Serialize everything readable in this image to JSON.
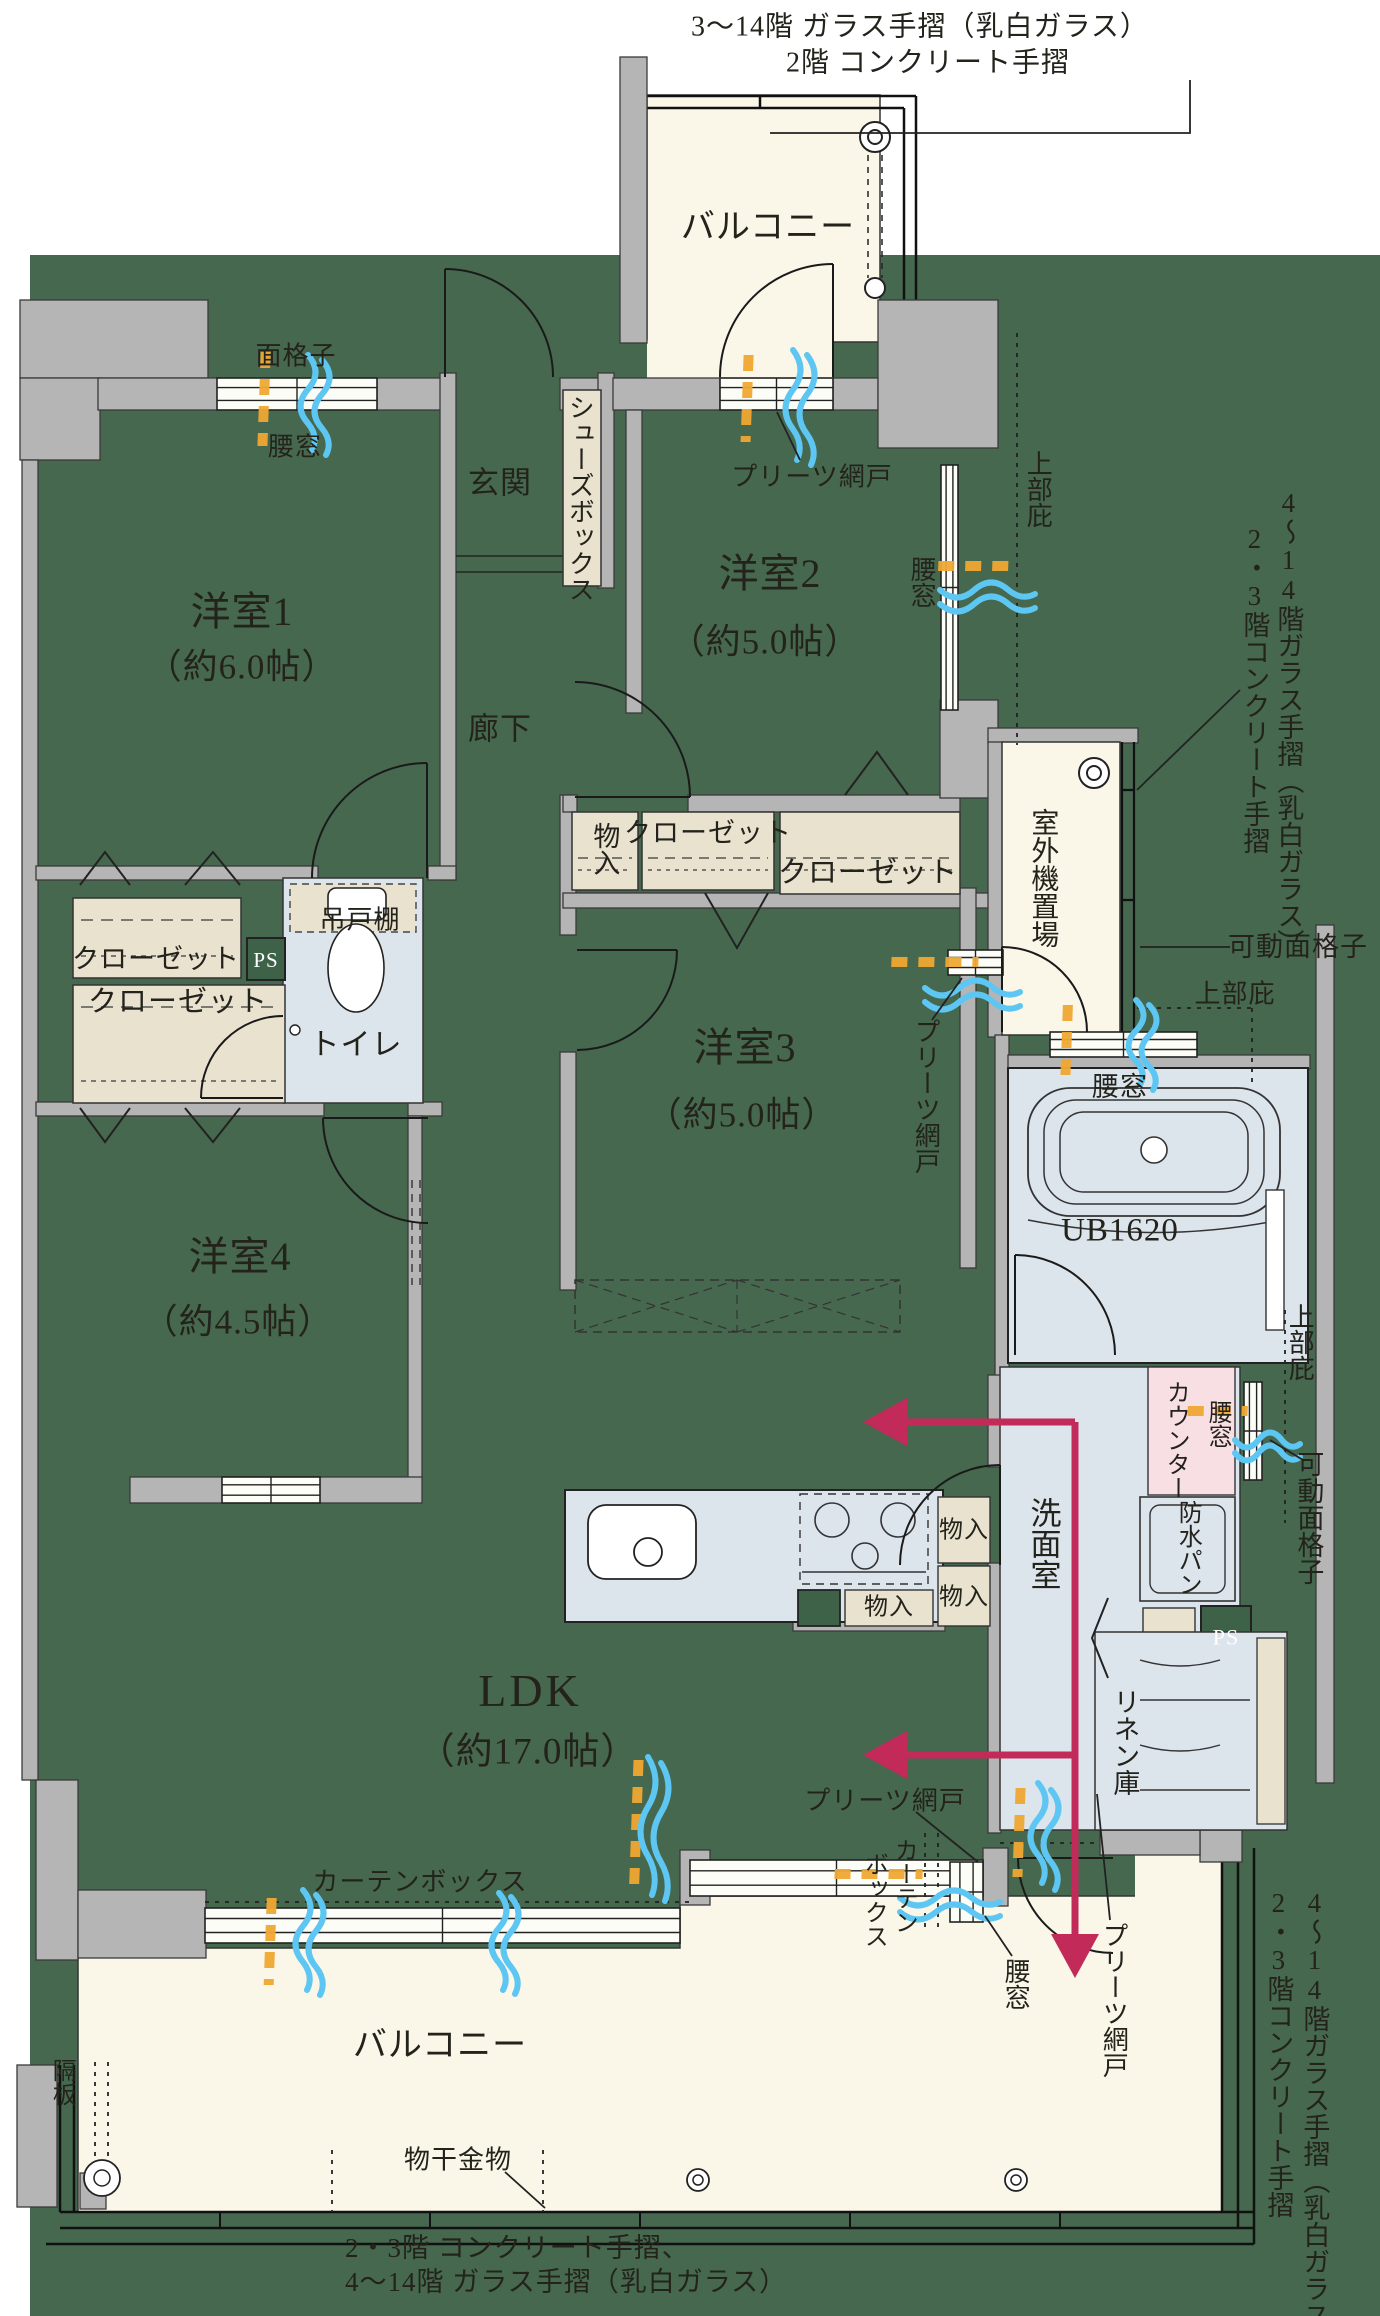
{
  "plan_title": "4LDK apartment floor plan",
  "rooms": {
    "balcony": "バルコニー",
    "yoshitsu1": "洋室1",
    "yoshitsu1_size": "（約6.0帖）",
    "yoshitsu2": "洋室2",
    "yoshitsu2_size": "（約5.0帖）",
    "yoshitsu3": "洋室3",
    "yoshitsu3_size": "（約5.0帖）",
    "yoshitsu4": "洋室4",
    "yoshitsu4_size": "（約4.5帖）",
    "ldk": "LDK",
    "ldk_size": "（約17.0帖）",
    "genkan": "玄関",
    "rouka": "廊下",
    "toilet": "トイレ",
    "senmen": "洗面室",
    "ub": "UB1620",
    "gaiki_okiba": "室外機置場",
    "linen": "リネン庫"
  },
  "fixtures": {
    "shoes_box": "シューズボックス",
    "closet": "クローゼット",
    "mono_iri": "物入",
    "tsurito_dana": "吊戸棚",
    "ps": "PS",
    "counter": "カウンター",
    "bousui_pan": "防水パン",
    "curtain_box": "カーテンボックス",
    "curtain": "カーテン",
    "box": "ボックス",
    "monohoshi": "物干金物",
    "kakuita": "隔板"
  },
  "openings": {
    "koshimado": "腰窓",
    "mengoshi": "面格子",
    "kadou_mengoshi": "可動面格子",
    "joubu_hisashi": "上部庇",
    "pleats_amido": "プリーツ網戸"
  },
  "annotations": {
    "top_1": "3〜14階 ガラス手摺（乳白ガラス）",
    "top_2": "2階 コンクリート手摺",
    "right_upper_1": "4〜14階ガラス手摺（乳白ガラス）",
    "right_upper_2": "2・3階コンクリート手摺",
    "right_lower_1": "4〜14階ガラス手摺（乳白ガラス）",
    "right_lower_2": "2・3階コンクリート手摺",
    "bottom_1": "2・3階 コンクリート手摺、",
    "bottom_2": "4〜14階 ガラス手摺（乳白ガラス）"
  },
  "colors": {
    "field_green": "#46684e",
    "wall_gray": "#b5b5b5",
    "balcony_cream": "#faf6e8",
    "storage_beige": "#e8e2cf",
    "wet_blue": "#dce4ec",
    "counter_pink": "#f8dfe4",
    "ps_green": "#3d6247",
    "flow_magenta": "#c22a5a",
    "air_blue": "#5ec6f2",
    "lattice_orange": "#f0a832"
  }
}
